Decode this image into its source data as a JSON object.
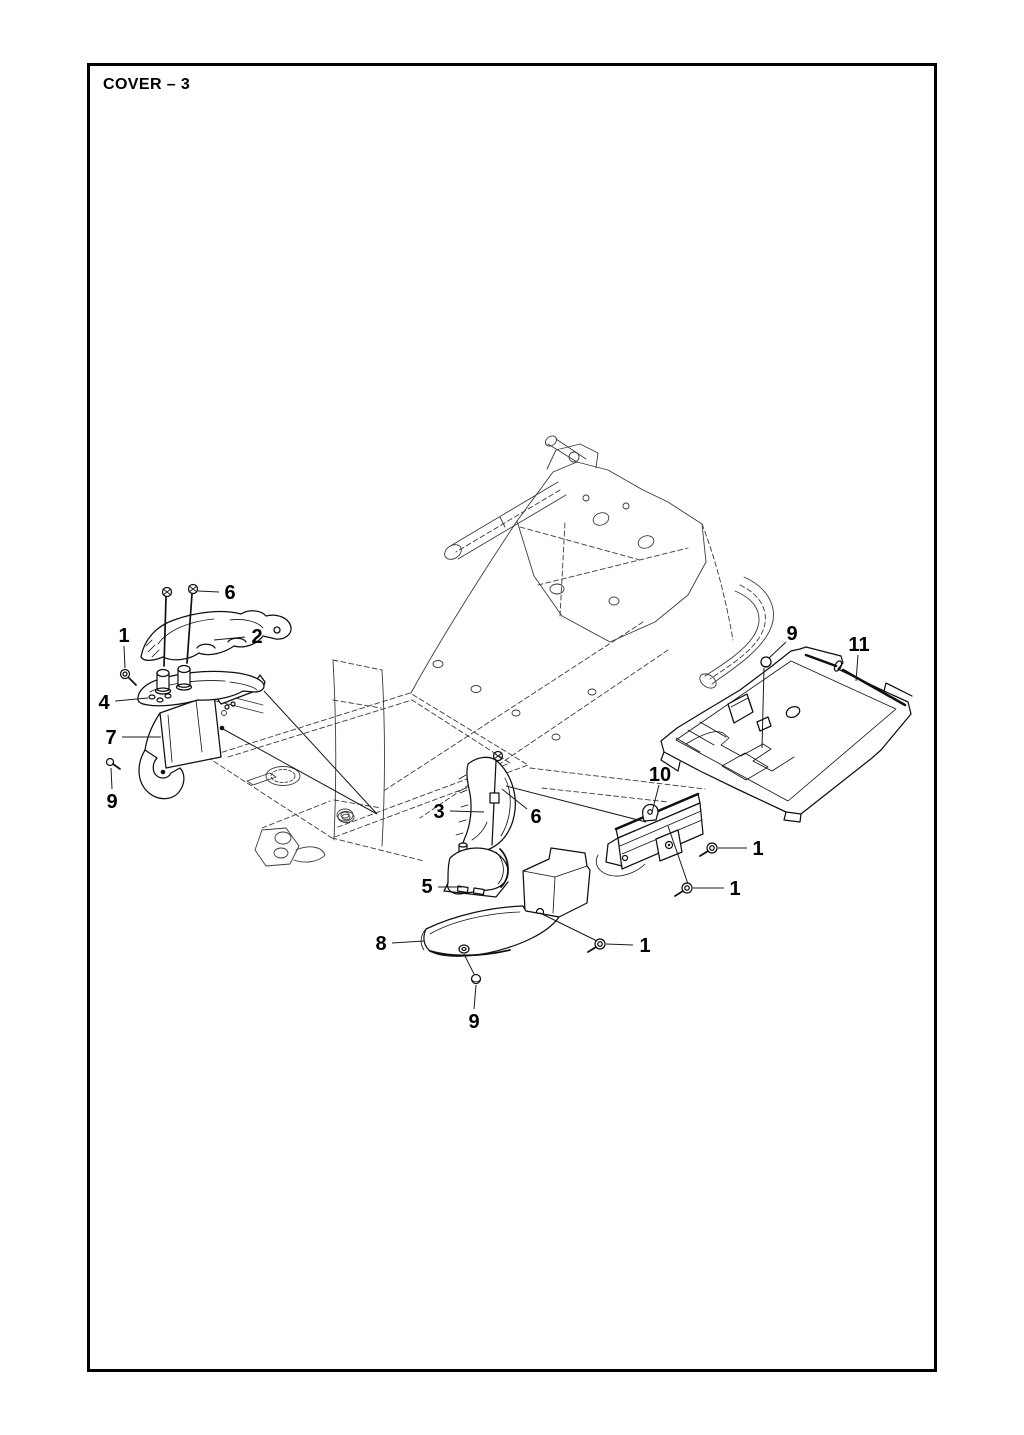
{
  "page": {
    "title": "COVER – 3"
  },
  "drawing": {
    "background": "#ffffff",
    "frame_color": "#000000",
    "line_color": "#1a1a1a",
    "callouts": [
      {
        "label": "6",
        "x": 230,
        "y": 592
      },
      {
        "label": "1",
        "x": 124,
        "y": 635
      },
      {
        "label": "2",
        "x": 257,
        "y": 636
      },
      {
        "label": "4",
        "x": 104,
        "y": 702
      },
      {
        "label": "7",
        "x": 111,
        "y": 737
      },
      {
        "label": "9",
        "x": 112,
        "y": 801
      },
      {
        "label": "3",
        "x": 439,
        "y": 811
      },
      {
        "label": "6",
        "x": 536,
        "y": 816
      },
      {
        "label": "5",
        "x": 427,
        "y": 886
      },
      {
        "label": "8",
        "x": 381,
        "y": 943
      },
      {
        "label": "1",
        "x": 645,
        "y": 945
      },
      {
        "label": "9",
        "x": 474,
        "y": 1021
      },
      {
        "label": "9",
        "x": 792,
        "y": 633
      },
      {
        "label": "11",
        "x": 859,
        "y": 644
      },
      {
        "label": "10",
        "x": 660,
        "y": 774
      },
      {
        "label": "1",
        "x": 758,
        "y": 848
      },
      {
        "label": "1",
        "x": 735,
        "y": 888
      }
    ],
    "leader_lines": [
      {
        "x1": 219,
        "y1": 592,
        "x2": 198,
        "y2": 591
      },
      {
        "x1": 124,
        "y1": 646,
        "x2": 125,
        "y2": 668
      },
      {
        "x1": 245,
        "y1": 637,
        "x2": 214,
        "y2": 640
      },
      {
        "x1": 115,
        "y1": 701,
        "x2": 148,
        "y2": 698
      },
      {
        "x1": 122,
        "y1": 737,
        "x2": 161,
        "y2": 737
      },
      {
        "x1": 112,
        "y1": 789,
        "x2": 111,
        "y2": 768
      },
      {
        "x1": 450,
        "y1": 811,
        "x2": 484,
        "y2": 812
      },
      {
        "x1": 527,
        "y1": 809,
        "x2": 502,
        "y2": 789
      },
      {
        "x1": 438,
        "y1": 887,
        "x2": 462,
        "y2": 887
      },
      {
        "x1": 392,
        "y1": 943,
        "x2": 424,
        "y2": 941
      },
      {
        "x1": 633,
        "y1": 945,
        "x2": 606,
        "y2": 944
      },
      {
        "x1": 474,
        "y1": 1009,
        "x2": 476,
        "y2": 985
      },
      {
        "x1": 786,
        "y1": 642,
        "x2": 769,
        "y2": 658
      },
      {
        "x1": 764,
        "y1": 668,
        "x2": 762,
        "y2": 748
      },
      {
        "x1": 858,
        "y1": 655,
        "x2": 856,
        "y2": 681
      },
      {
        "x1": 659,
        "y1": 785,
        "x2": 652,
        "y2": 812
      },
      {
        "x1": 747,
        "y1": 848,
        "x2": 718,
        "y2": 848
      },
      {
        "x1": 724,
        "y1": 888,
        "x2": 693,
        "y2": 888
      },
      {
        "x1": 264,
        "y1": 691,
        "x2": 377,
        "y2": 814
      },
      {
        "x1": 223,
        "y1": 729,
        "x2": 377,
        "y2": 814
      },
      {
        "x1": 506,
        "y1": 786,
        "x2": 646,
        "y2": 822
      },
      {
        "x1": 668,
        "y1": 826,
        "x2": 688,
        "y2": 884
      },
      {
        "x1": 540,
        "y1": 913,
        "x2": 597,
        "y2": 941
      },
      {
        "x1": 464,
        "y1": 954,
        "x2": 474,
        "y2": 974
      }
    ]
  }
}
